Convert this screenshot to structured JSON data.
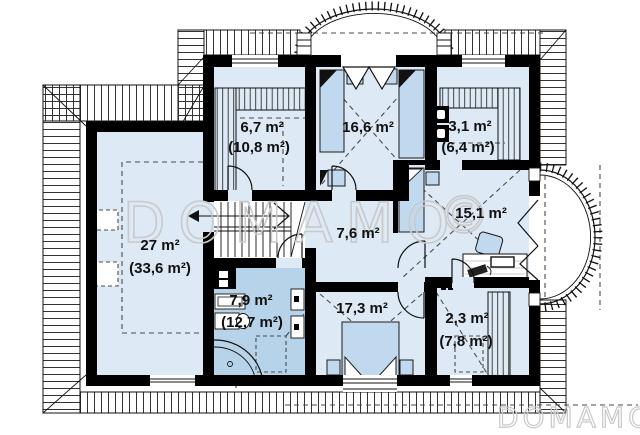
{
  "rooms": [
    {
      "area": "6,7 m²",
      "area_total": "(10,8 m²)"
    },
    {
      "area": "16,6 m²"
    },
    {
      "area": "3,1 m²",
      "area_total": "(6,4 m²)"
    },
    {
      "area": "15,1 m²"
    },
    {
      "area": "27 m²",
      "area_total": "(33,6 m²)"
    },
    {
      "area": "7,6 m²"
    },
    {
      "area": "7,9 m²",
      "area_total": "(12,7 m²)"
    },
    {
      "area": "17,3 m²"
    },
    {
      "area": "2,3 m²",
      "area_total": "(7,8 m²)"
    }
  ],
  "watermark": {
    "center": "DOMAMO",
    "copyright": "©",
    "corner": "DOMAMO"
  },
  "colors": {
    "floor": "#dde9f4",
    "floor_bathroom": "#b7d3e9",
    "furniture": "#c1d9ee",
    "wall": "#000000",
    "watermark": "#c9c9c9"
  }
}
